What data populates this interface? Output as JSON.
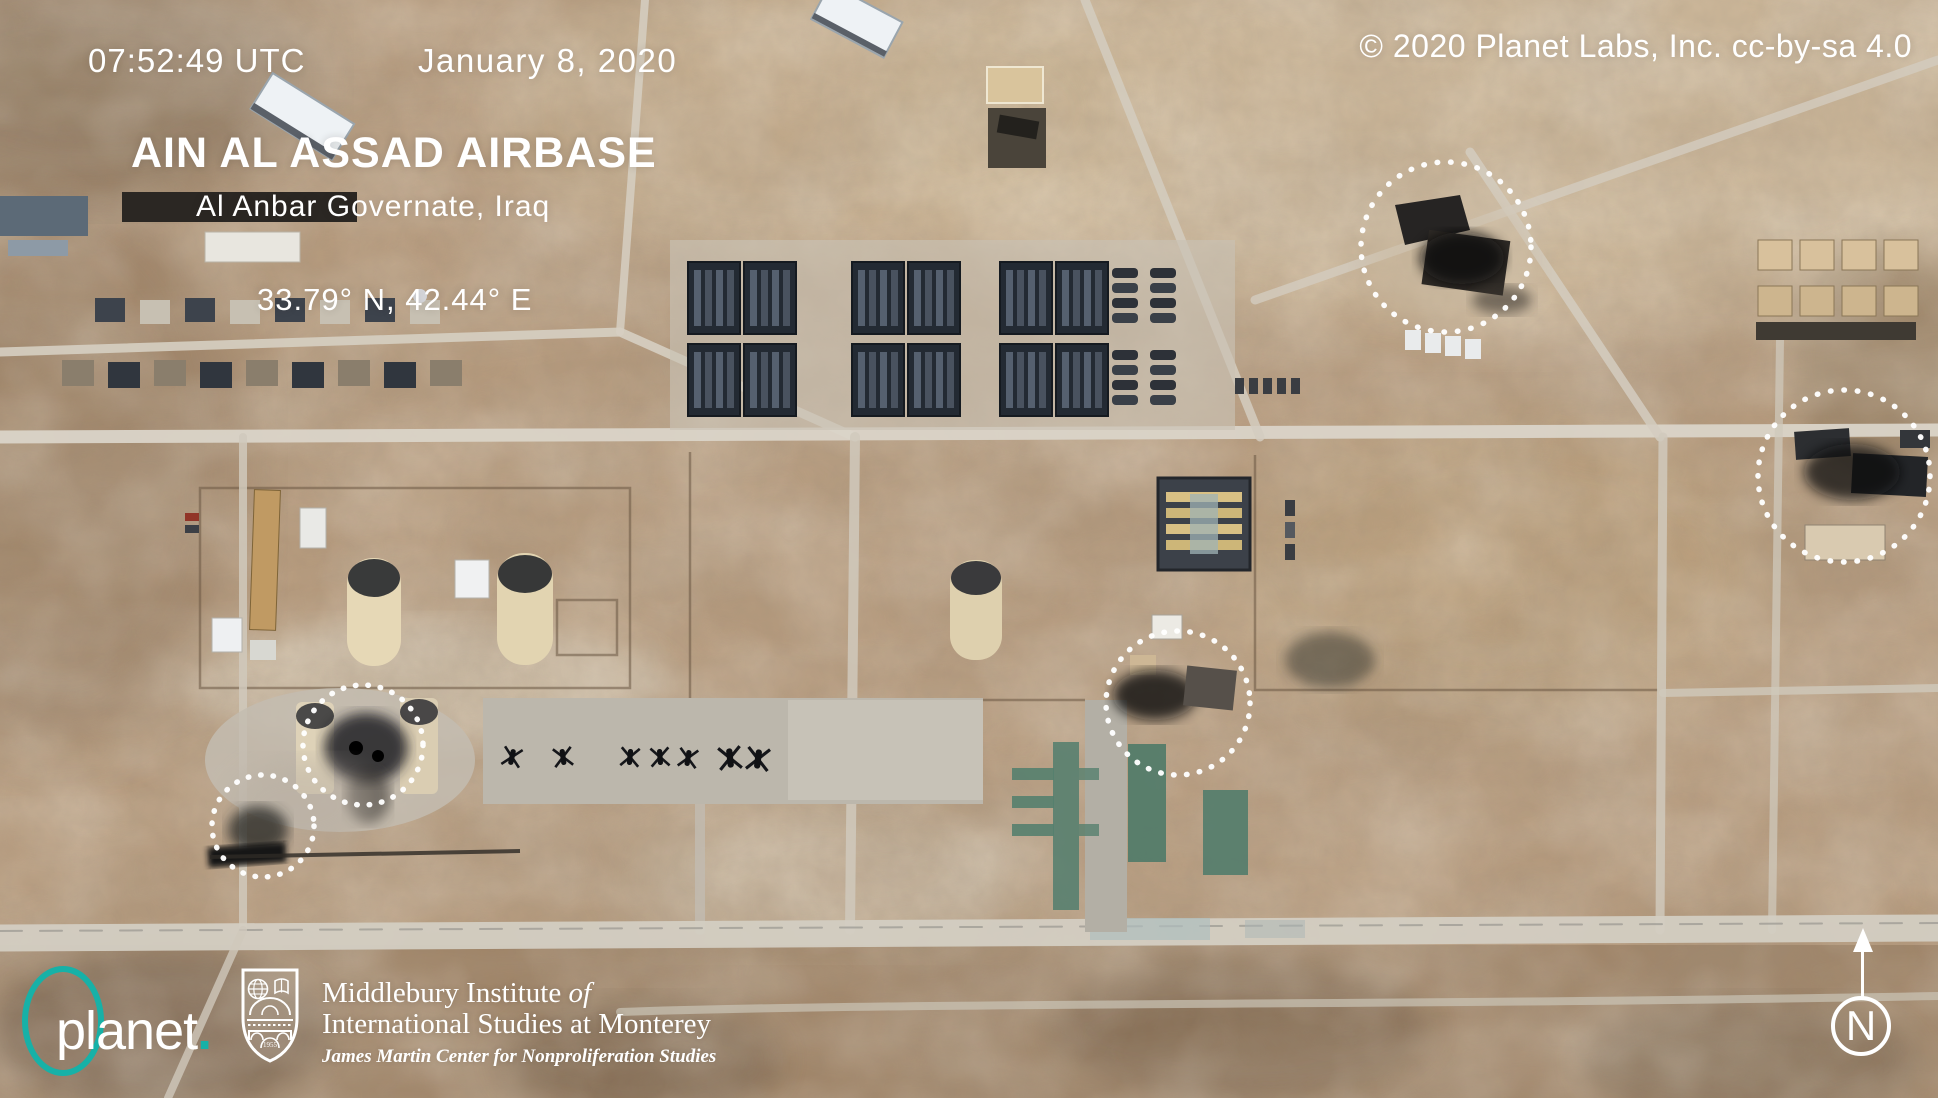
{
  "header": {
    "timestamp": "07:52:49 UTC",
    "date": "January 8, 2020",
    "copyright": "© 2020 Planet Labs, Inc. cc-by-sa 4.0"
  },
  "location": {
    "title": "AIN AL ASSAD AIRBASE",
    "subtitle": "Al Anbar Governate, Iraq",
    "coordinates": "33.79° N, 42.44° E"
  },
  "annotations": {
    "description": "white dotted circles marking strike damage",
    "count": 5,
    "circle_color": "#ffffff"
  },
  "compass": {
    "label": "N"
  },
  "footer": {
    "planet": {
      "wordmark": "planet",
      "dot": ".",
      "accent_color": "#17b1a7"
    },
    "institute": {
      "line1": "Middlebury Institute",
      "line1_italic": "of",
      "line2": "International Studies at Monterey",
      "line3": "James Martin Center for Nonproliferation Studies",
      "shield_year": "1955"
    }
  }
}
